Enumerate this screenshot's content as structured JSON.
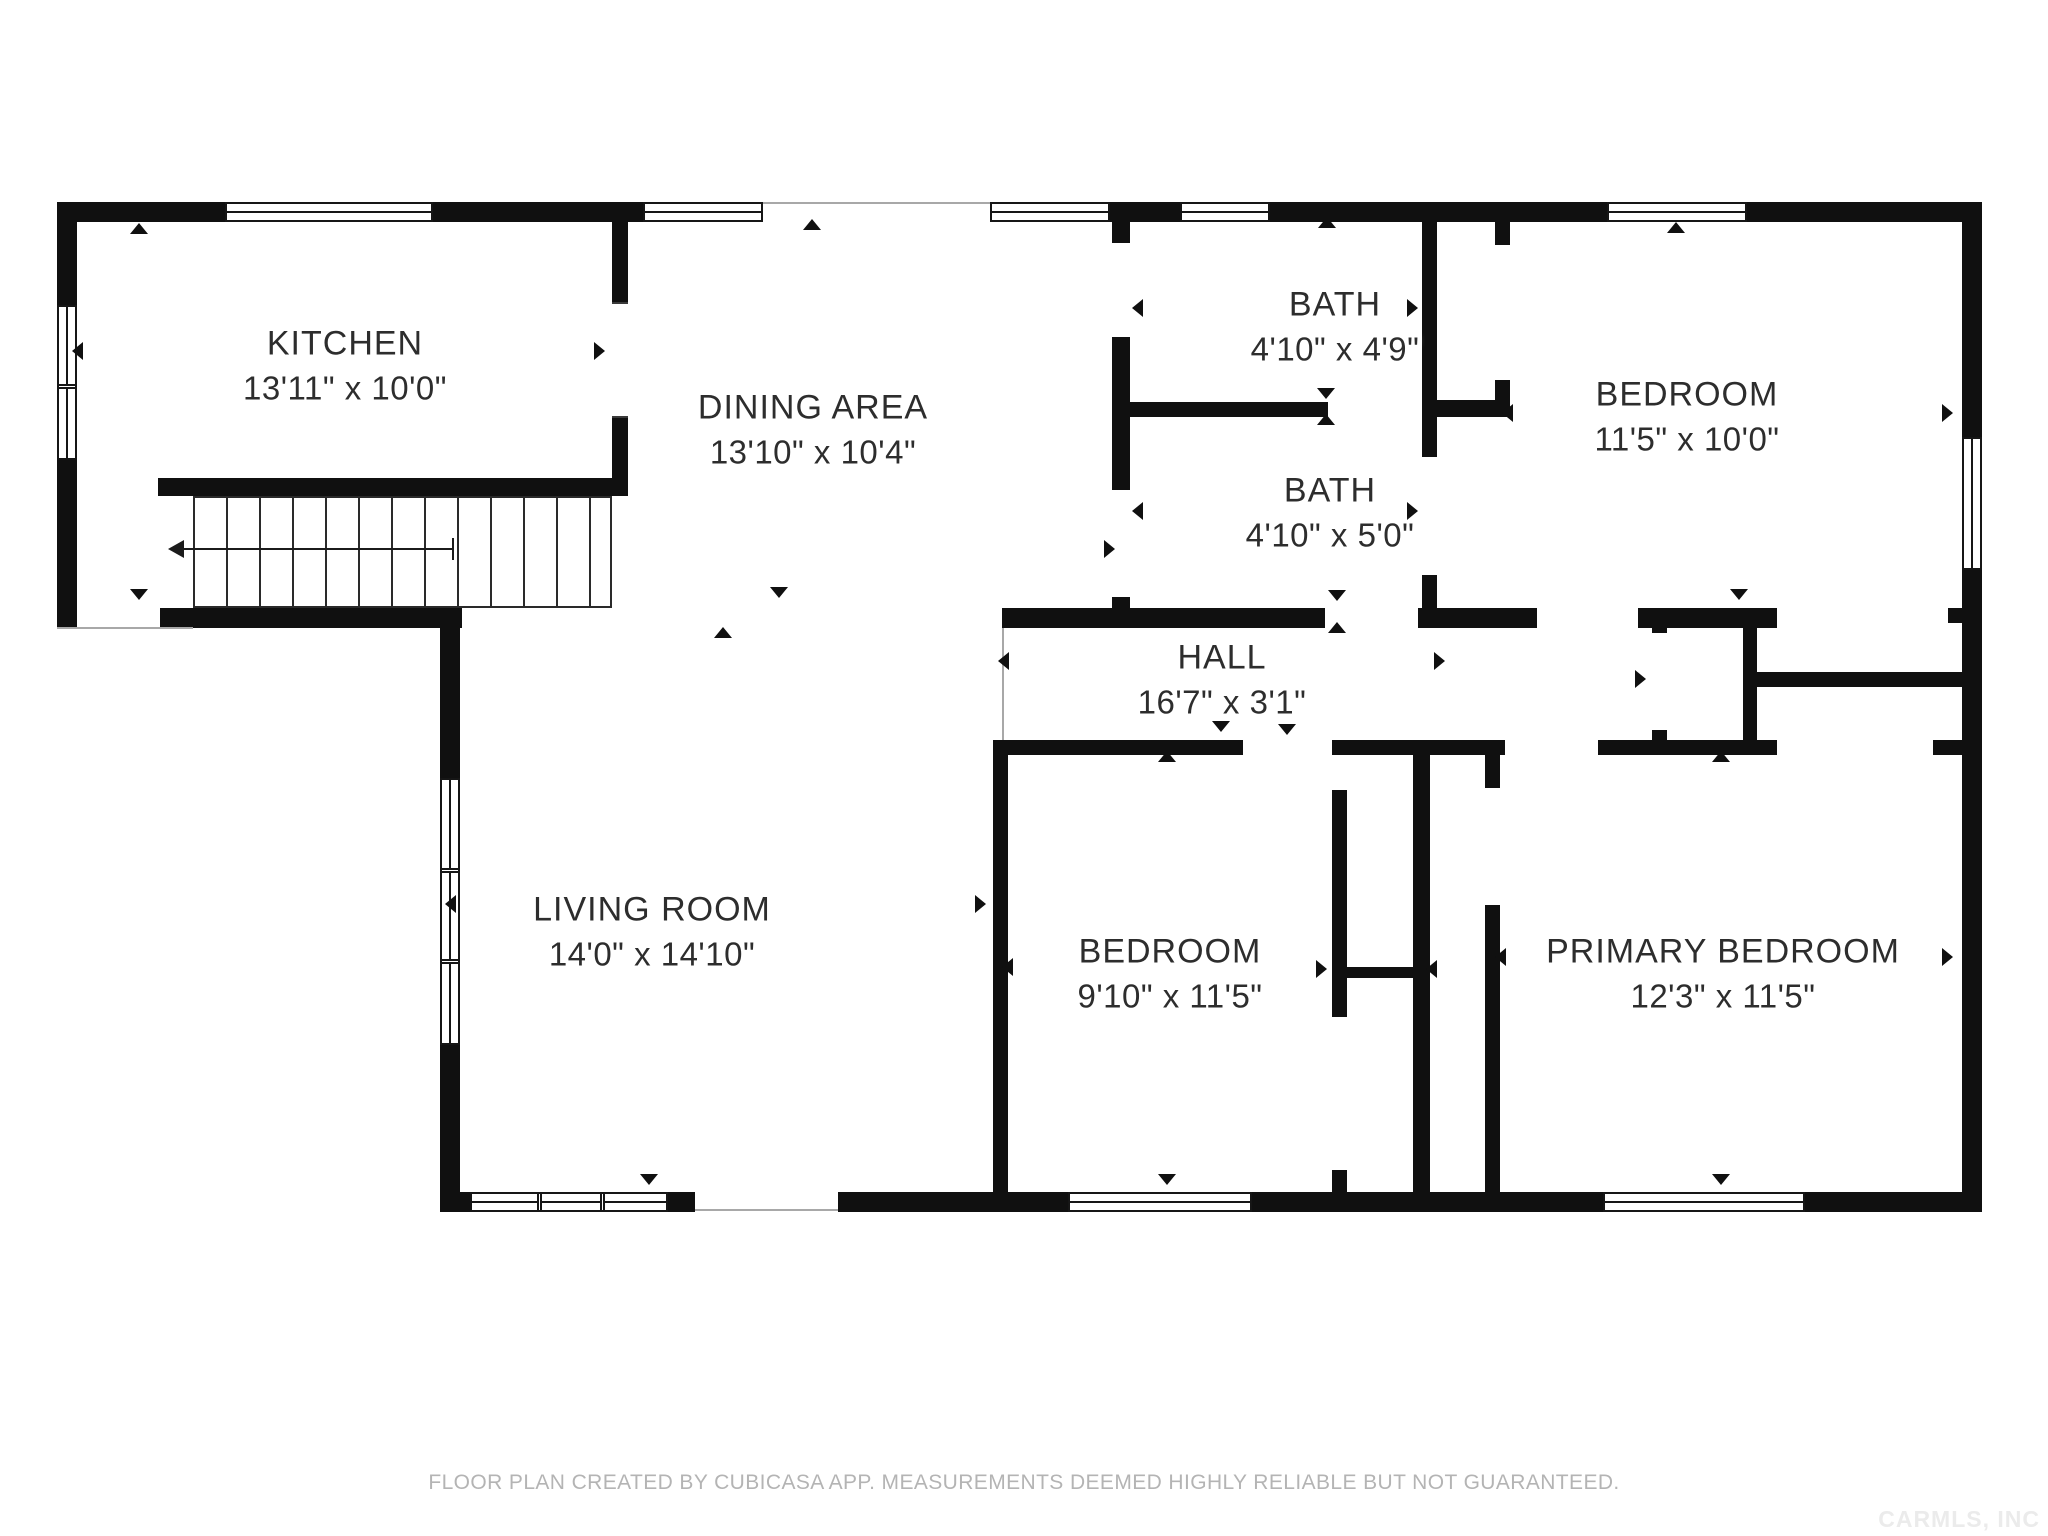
{
  "page": {
    "footer_note": "FLOOR PLAN CREATED BY CUBICASA APP. MEASUREMENTS DEEMED HIGHLY RELIABLE BUT NOT GUARANTEED.",
    "watermark": "CARMLS, INC",
    "wall_color": "#101010",
    "background_color": "#ffffff"
  },
  "rooms": [
    {
      "name": "KITCHEN",
      "dims": "13'11\" x 10'0\"",
      "x": 345,
      "y": 366
    },
    {
      "name": "DINING AREA",
      "dims": "13'10\" x 10'4\"",
      "x": 813,
      "y": 430
    },
    {
      "name": "BATH",
      "dims": "4'10\" x 4'9\"",
      "x": 1335,
      "y": 327
    },
    {
      "name": "BATH",
      "dims": "4'10\" x 5'0\"",
      "x": 1330,
      "y": 513
    },
    {
      "name": "BEDROOM",
      "dims": "11'5\" x 10'0\"",
      "x": 1687,
      "y": 417
    },
    {
      "name": "HALL",
      "dims": "16'7\" x 3'1\"",
      "x": 1222,
      "y": 680
    },
    {
      "name": "LIVING ROOM",
      "dims": "14'0\" x 14'10\"",
      "x": 652,
      "y": 932
    },
    {
      "name": "BEDROOM",
      "dims": "9'10\" x 11'5\"",
      "x": 1170,
      "y": 974
    },
    {
      "name": "PRIMARY BEDROOM",
      "dims": "12'3\" x 11'5\"",
      "x": 1723,
      "y": 974
    }
  ],
  "walls": [
    {
      "x": 57,
      "y": 202,
      "w": 168,
      "h": 20
    },
    {
      "x": 433,
      "y": 202,
      "w": 210,
      "h": 20
    },
    {
      "x": 1110,
      "y": 202,
      "w": 70,
      "h": 20
    },
    {
      "x": 1270,
      "y": 202,
      "w": 337,
      "h": 20
    },
    {
      "x": 1747,
      "y": 202,
      "w": 235,
      "h": 20
    },
    {
      "x": 1962,
      "y": 202,
      "w": 20,
      "h": 235
    },
    {
      "x": 1962,
      "y": 570,
      "w": 20,
      "h": 642
    },
    {
      "x": 440,
      "y": 1192,
      "w": 30,
      "h": 20
    },
    {
      "x": 668,
      "y": 1192,
      "w": 27,
      "h": 20
    },
    {
      "x": 838,
      "y": 1192,
      "w": 230,
      "h": 20
    },
    {
      "x": 1252,
      "y": 1192,
      "w": 351,
      "h": 20
    },
    {
      "x": 1805,
      "y": 1192,
      "w": 177,
      "h": 20
    },
    {
      "x": 57,
      "y": 202,
      "w": 20,
      "h": 103
    },
    {
      "x": 57,
      "y": 460,
      "w": 20,
      "h": 167
    },
    {
      "x": 440,
      "y": 608,
      "w": 20,
      "h": 170
    },
    {
      "x": 440,
      "y": 1045,
      "w": 20,
      "h": 147
    },
    {
      "x": 612,
      "y": 222,
      "w": 16,
      "h": 80
    },
    {
      "x": 612,
      "y": 418,
      "w": 16,
      "h": 60
    },
    {
      "x": 158,
      "y": 478,
      "w": 470,
      "h": 18
    },
    {
      "x": 160,
      "y": 608,
      "w": 302,
      "h": 20
    },
    {
      "x": 1112,
      "y": 220,
      "w": 18,
      "h": 23
    },
    {
      "x": 1112,
      "y": 337,
      "w": 18,
      "h": 153
    },
    {
      "x": 1112,
      "y": 597,
      "w": 18,
      "h": 31
    },
    {
      "x": 1422,
      "y": 220,
      "w": 15,
      "h": 237
    },
    {
      "x": 1422,
      "y": 575,
      "w": 15,
      "h": 53
    },
    {
      "x": 1495,
      "y": 222,
      "w": 15,
      "h": 23
    },
    {
      "x": 1495,
      "y": 380,
      "w": 15,
      "h": 37
    },
    {
      "x": 1130,
      "y": 402,
      "w": 198,
      "h": 15
    },
    {
      "x": 1422,
      "y": 400,
      "w": 88,
      "h": 17
    },
    {
      "x": 1002,
      "y": 608,
      "w": 323,
      "h": 20
    },
    {
      "x": 1418,
      "y": 608,
      "w": 119,
      "h": 20
    },
    {
      "x": 1638,
      "y": 608,
      "w": 139,
      "h": 20
    },
    {
      "x": 993,
      "y": 740,
      "w": 250,
      "h": 15
    },
    {
      "x": 1332,
      "y": 740,
      "w": 173,
      "h": 15
    },
    {
      "x": 1598,
      "y": 740,
      "w": 179,
      "h": 15
    },
    {
      "x": 993,
      "y": 755,
      "w": 15,
      "h": 437
    },
    {
      "x": 1332,
      "y": 790,
      "w": 15,
      "h": 227
    },
    {
      "x": 1332,
      "y": 1170,
      "w": 15,
      "h": 22
    },
    {
      "x": 1413,
      "y": 755,
      "w": 17,
      "h": 212
    },
    {
      "x": 1413,
      "y": 978,
      "w": 17,
      "h": 214
    },
    {
      "x": 1332,
      "y": 967,
      "w": 98,
      "h": 11
    },
    {
      "x": 1485,
      "y": 755,
      "w": 15,
      "h": 33
    },
    {
      "x": 1485,
      "y": 905,
      "w": 15,
      "h": 287
    },
    {
      "x": 1652,
      "y": 623,
      "w": 15,
      "h": 10
    },
    {
      "x": 1652,
      "y": 730,
      "w": 15,
      "h": 10
    },
    {
      "x": 1743,
      "y": 608,
      "w": 14,
      "h": 147
    },
    {
      "x": 1757,
      "y": 672,
      "w": 205,
      "h": 15
    },
    {
      "x": 1948,
      "y": 608,
      "w": 14,
      "h": 15
    },
    {
      "x": 1933,
      "y": 740,
      "w": 29,
      "h": 15
    }
  ],
  "windows": [
    {
      "x": 225,
      "y": 202,
      "w": 208,
      "h": 20,
      "orient": "h",
      "dividers": []
    },
    {
      "x": 643,
      "y": 202,
      "w": 120,
      "h": 20,
      "orient": "h",
      "dividers": []
    },
    {
      "x": 990,
      "y": 202,
      "w": 120,
      "h": 20,
      "orient": "h",
      "dividers": []
    },
    {
      "x": 1180,
      "y": 202,
      "w": 90,
      "h": 20,
      "orient": "h",
      "dividers": []
    },
    {
      "x": 1607,
      "y": 202,
      "w": 140,
      "h": 20,
      "orient": "h",
      "dividers": []
    },
    {
      "x": 1962,
      "y": 437,
      "w": 20,
      "h": 133,
      "orient": "v",
      "dividers": []
    },
    {
      "x": 57,
      "y": 305,
      "w": 20,
      "h": 155,
      "orient": "v",
      "dividers": [
        77
      ]
    },
    {
      "x": 440,
      "y": 778,
      "w": 20,
      "h": 267,
      "orient": "v",
      "dividers": [
        88,
        179
      ]
    },
    {
      "x": 470,
      "y": 1192,
      "w": 198,
      "h": 20,
      "orient": "h",
      "dividers": [
        65,
        128
      ]
    },
    {
      "x": 1068,
      "y": 1192,
      "w": 184,
      "h": 20,
      "orient": "h",
      "dividers": []
    },
    {
      "x": 1603,
      "y": 1192,
      "w": 202,
      "h": 20,
      "orient": "h",
      "dividers": []
    }
  ],
  "openings": [
    {
      "x": 612,
      "y": 302,
      "w": 16,
      "h": 116
    }
  ],
  "thin_lines": [
    {
      "x": 57,
      "y": 627,
      "w": 136,
      "h": 2
    },
    {
      "x": 763,
      "y": 202,
      "w": 227,
      "h": 2
    },
    {
      "x": 695,
      "y": 1209,
      "w": 143,
      "h": 2
    },
    {
      "x": 1002,
      "y": 628,
      "w": 2,
      "h": 112
    }
  ],
  "arrows": [
    {
      "dir": "up",
      "x": 140,
      "y": 233
    },
    {
      "dir": "up",
      "x": 813,
      "y": 229
    },
    {
      "dir": "up",
      "x": 724,
      "y": 637
    },
    {
      "dir": "up",
      "x": 1168,
      "y": 761
    },
    {
      "dir": "up",
      "x": 1722,
      "y": 761
    },
    {
      "dir": "up",
      "x": 1677,
      "y": 232
    },
    {
      "dir": "up",
      "x": 1328,
      "y": 227
    },
    {
      "dir": "up",
      "x": 1338,
      "y": 632
    },
    {
      "dir": "up",
      "x": 1327,
      "y": 424
    },
    {
      "dir": "down",
      "x": 140,
      "y": 599
    },
    {
      "dir": "down",
      "x": 780,
      "y": 597
    },
    {
      "dir": "down",
      "x": 650,
      "y": 1184
    },
    {
      "dir": "down",
      "x": 1168,
      "y": 1184
    },
    {
      "dir": "down",
      "x": 1722,
      "y": 1184
    },
    {
      "dir": "down",
      "x": 1740,
      "y": 599
    },
    {
      "dir": "down",
      "x": 1288,
      "y": 734
    },
    {
      "dir": "down",
      "x": 1222,
      "y": 731
    },
    {
      "dir": "down",
      "x": 1338,
      "y": 600
    },
    {
      "dir": "down",
      "x": 1327,
      "y": 398
    },
    {
      "dir": "left",
      "x": 82,
      "y": 352
    },
    {
      "dir": "left",
      "x": 455,
      "y": 905
    },
    {
      "dir": "left",
      "x": 1012,
      "y": 968
    },
    {
      "dir": "left",
      "x": 1142,
      "y": 309
    },
    {
      "dir": "left",
      "x": 1142,
      "y": 512
    },
    {
      "dir": "left",
      "x": 1512,
      "y": 414
    },
    {
      "dir": "left",
      "x": 1505,
      "y": 958
    },
    {
      "dir": "left",
      "x": 1436,
      "y": 970
    },
    {
      "dir": "left",
      "x": 1008,
      "y": 662
    },
    {
      "dir": "right",
      "x": 604,
      "y": 352
    },
    {
      "dir": "right",
      "x": 985,
      "y": 905
    },
    {
      "dir": "right",
      "x": 1417,
      "y": 309
    },
    {
      "dir": "right",
      "x": 1417,
      "y": 512
    },
    {
      "dir": "right",
      "x": 1952,
      "y": 414
    },
    {
      "dir": "right",
      "x": 1952,
      "y": 958
    },
    {
      "dir": "right",
      "x": 1326,
      "y": 970
    },
    {
      "dir": "right",
      "x": 1645,
      "y": 680
    },
    {
      "dir": "right",
      "x": 1114,
      "y": 550
    },
    {
      "dir": "right",
      "x": 1444,
      "y": 662
    }
  ],
  "stairs": {
    "x": 193,
    "y": 496,
    "w": 419,
    "h": 112,
    "arrow": {
      "y": 549,
      "x1": 182,
      "x2": 452
    }
  }
}
